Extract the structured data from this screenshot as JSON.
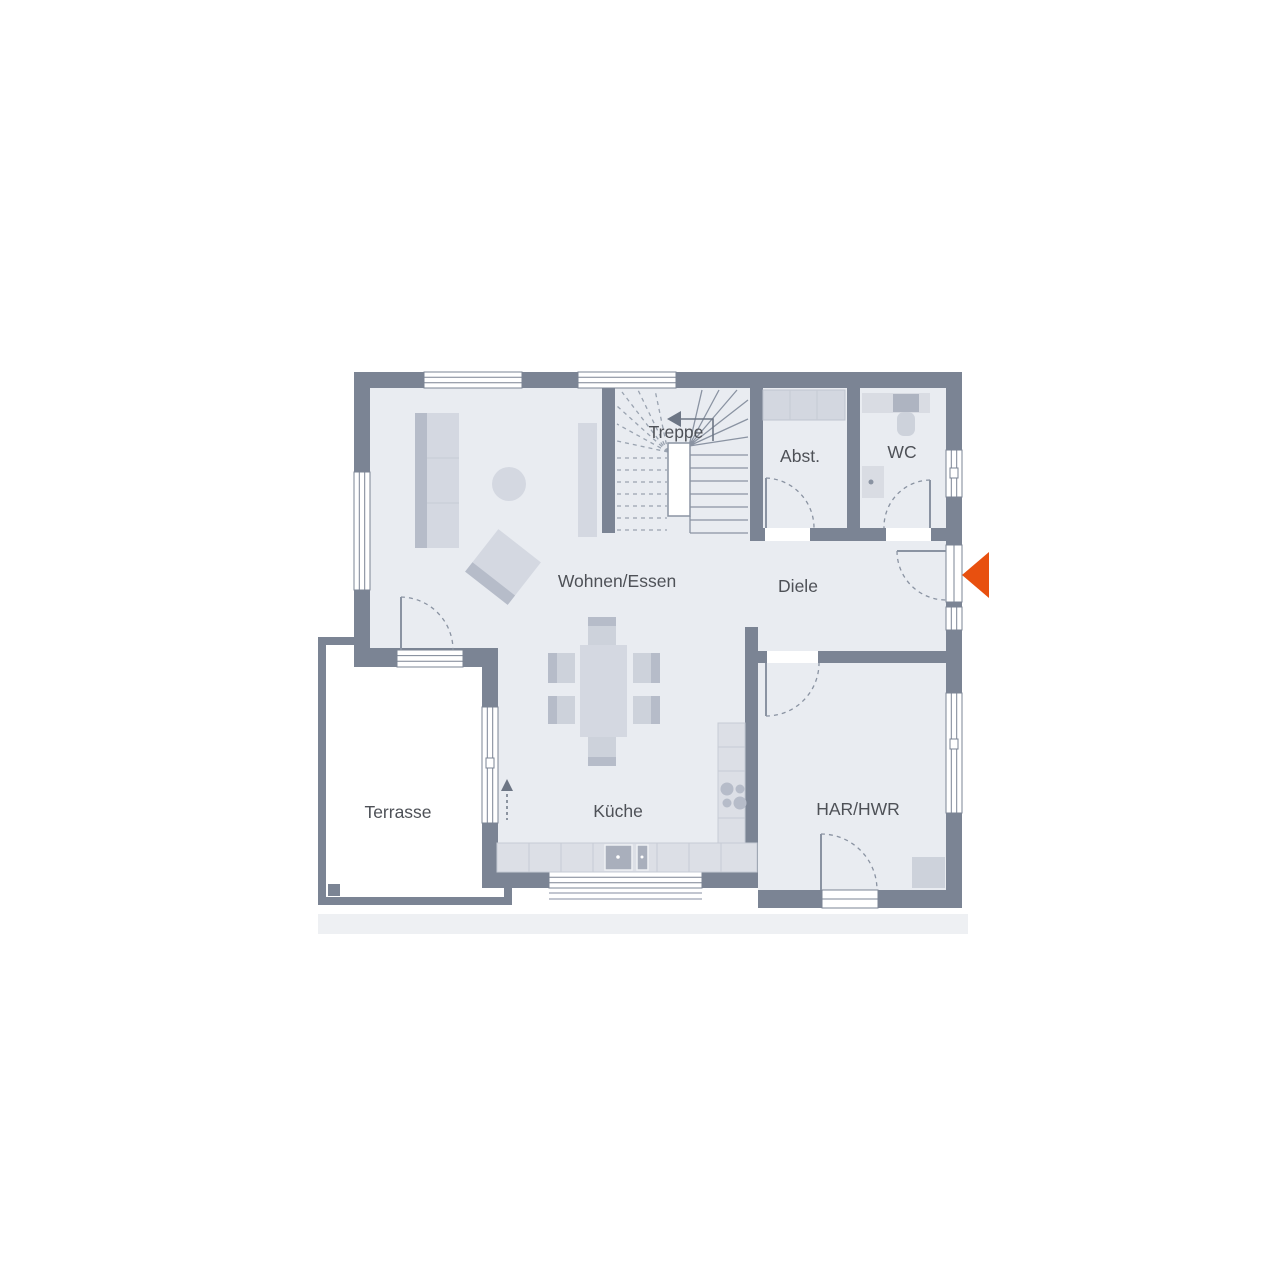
{
  "rooms": [
    {
      "id": "treppe",
      "label": "Treppe"
    },
    {
      "id": "abst",
      "label": "Abst."
    },
    {
      "id": "wc",
      "label": "WC"
    },
    {
      "id": "wohnen-essen",
      "label": "Wohnen/Essen"
    },
    {
      "id": "diele",
      "label": "Diele"
    },
    {
      "id": "terrasse",
      "label": "Terrasse"
    },
    {
      "id": "kueche",
      "label": "Küche"
    },
    {
      "id": "har-hwr",
      "label": "HAR/HWR"
    }
  ],
  "icons": {
    "entrance_arrow": "left-pointing-triangle",
    "stairs_up_arrow": "left-pointing-arrow-with-tail",
    "terrace_door_arrow": "up-pointing-triangle-with-dashed-tail"
  },
  "colors": {
    "wall": "#7b8494",
    "floor": "#e9ecf1",
    "terrace": "#ffffff",
    "furniture": "#d4d8e1",
    "furniture_dark": "#b6bcc9",
    "counter": "#dcdfe6",
    "fixture": "#cdd2db",
    "fixture_dark": "#aeb4c1",
    "accent": "#e8500f",
    "text": "#4e5157",
    "line": "#8a93a2",
    "line_light": "#9aa3b0"
  }
}
